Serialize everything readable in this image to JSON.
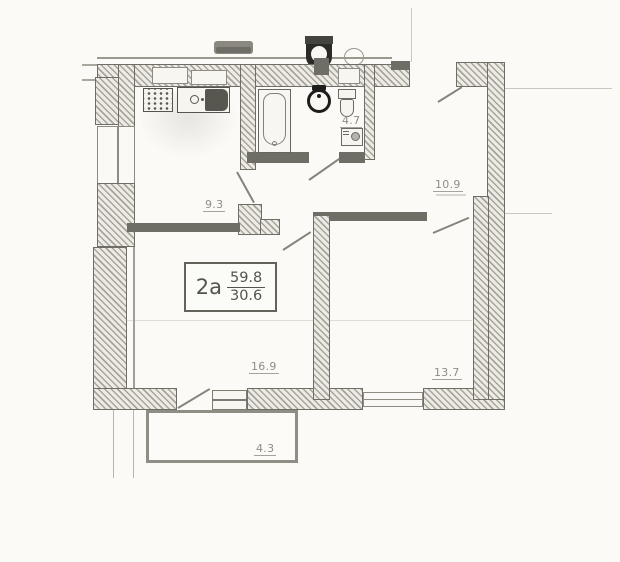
{
  "document": {
    "plan_kind": "apartment-floor-plan",
    "type_label": "2a",
    "total_area": "59.8",
    "living_area": "30.6"
  },
  "rooms": [
    {
      "name": "kitchen",
      "area": "9.3"
    },
    {
      "name": "bathroom",
      "area": "4.7"
    },
    {
      "name": "hallway",
      "area": "10.9"
    },
    {
      "name": "living-room",
      "area": "16.9"
    },
    {
      "name": "bedroom",
      "area": "13.7"
    },
    {
      "name": "balcony",
      "area": "4.3"
    }
  ],
  "fixtures": [
    "stove",
    "kitchen-sink",
    "bathtub",
    "washbasin",
    "toilet",
    "washing-machine"
  ],
  "colors": {
    "wall": "#6f6e66",
    "hatch_bg": "#edebe4",
    "thin_line": "#c9c7bf",
    "label": "#8f8d85",
    "paper": "#fbfaf7",
    "dark_fixture": "#1d1d1b"
  }
}
